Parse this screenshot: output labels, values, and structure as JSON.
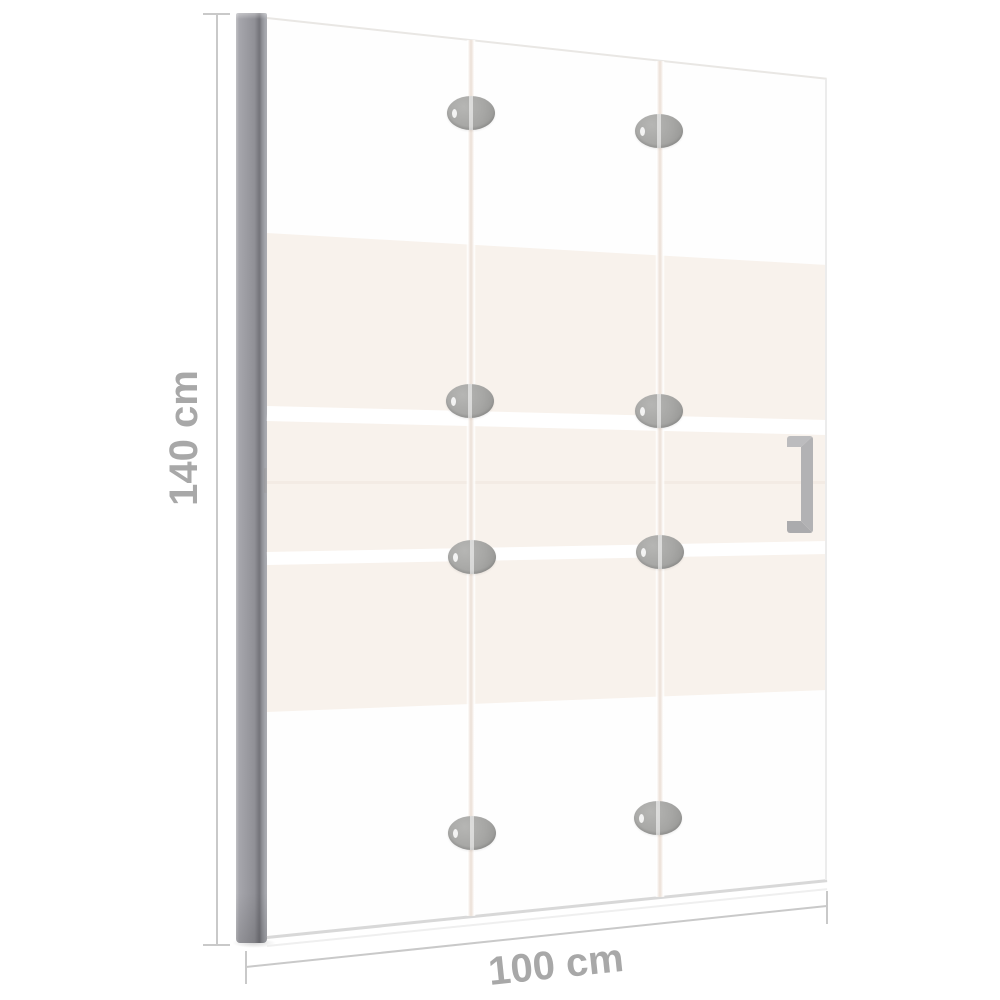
{
  "diagram": {
    "type": "folding-shower-screen-dimension-diagram",
    "height": {
      "label": "140 cm"
    },
    "width": {
      "label": "100 cm"
    },
    "panel_count": 3,
    "hinge_count": 8,
    "colors": {
      "background": "#ffffff",
      "dimension_line": "#c9c9c9",
      "dimension_text": "#a8a8a8",
      "wall_profile": "#97979d",
      "frosted_band": "#f8f2ec",
      "hinge": "#a5a5a3",
      "handle": "#b3b3b5"
    }
  }
}
